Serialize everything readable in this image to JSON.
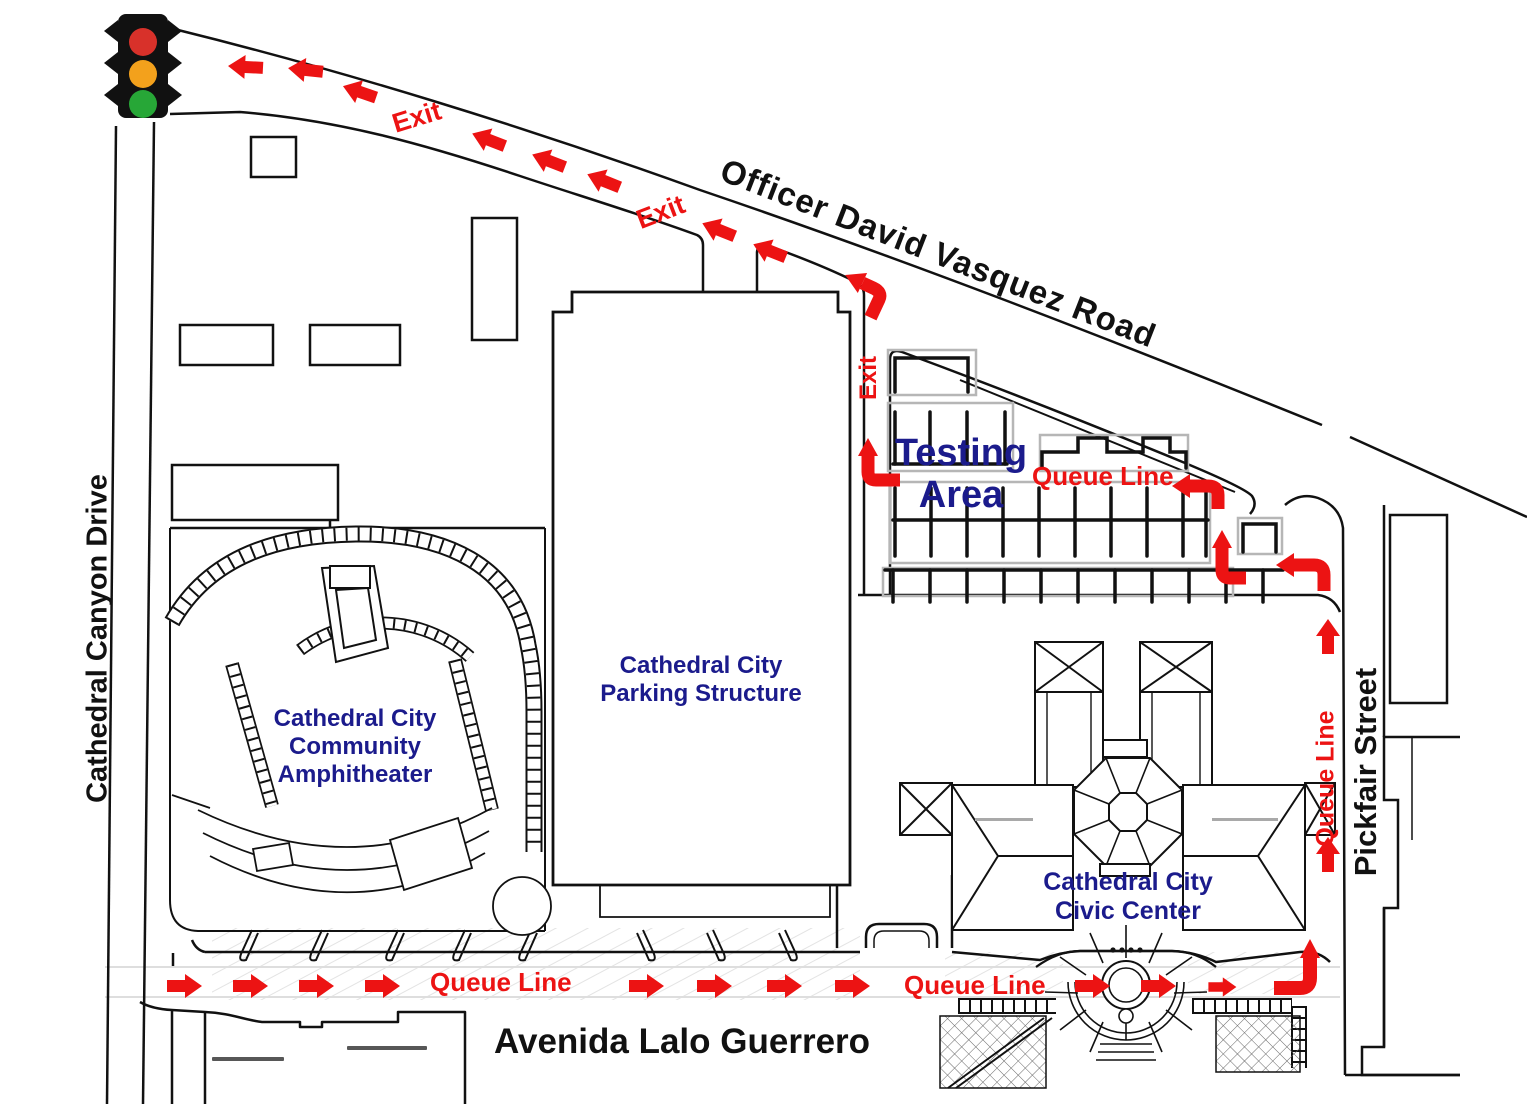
{
  "map": {
    "roads": {
      "top_diagonal": "Officer David Vasquez Road",
      "west_vertical": "Cathedral Canyon Drive",
      "east_vertical": "Pickfair Street",
      "south_horizontal": "Avenida Lalo Guerrero"
    },
    "places": {
      "amphitheater_lines": [
        "Cathedral City",
        "Community",
        "Amphitheater"
      ],
      "parking_lines": [
        "Cathedral City",
        "Parking Structure"
      ],
      "civic_lines": [
        "Cathedral City",
        "Civic Center"
      ],
      "testing_lines": [
        "Testing",
        "Area"
      ]
    },
    "route_labels": {
      "exit": "Exit",
      "queue_line": "Queue Line"
    },
    "icons": {
      "traffic_signal": "traffic-signal-icon",
      "route_arrow": "route-arrow-icon"
    },
    "colors": {
      "route_red": "#ec1313",
      "place_navy": "#1b1b8c",
      "line_ink": "#111111",
      "parcel_gray": "#b6b6b6",
      "signal_red": "#d8312a",
      "signal_amber": "#f3a11c",
      "signal_green": "#27a737"
    }
  }
}
